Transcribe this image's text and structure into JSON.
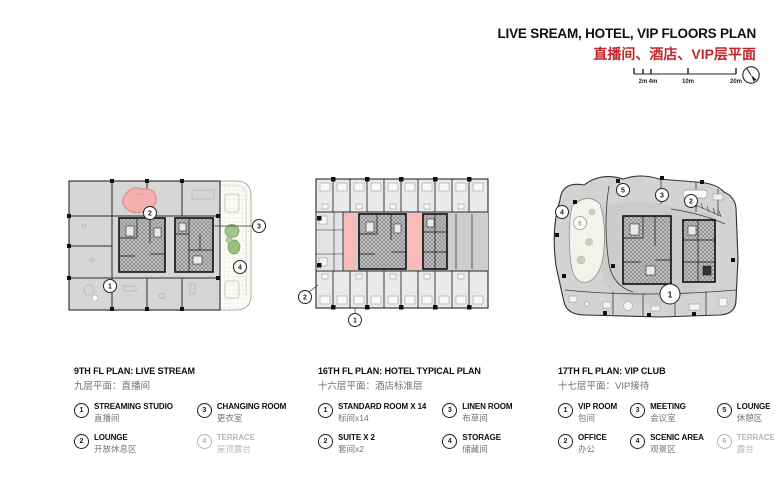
{
  "header": {
    "title": "LIVE SREAM, HOTEL, VIP FLOORS PLAN",
    "subtitle_cn": "直播间、酒店、VIP层平面",
    "accent_color": "#c0272d",
    "scale_bar": {
      "labels": [
        "2m",
        "4m",
        "10m",
        "20m"
      ]
    }
  },
  "plans": [
    {
      "title_en": "9TH FL PLAN: LIVE STREAM",
      "title_cn": "九层平面：直播间",
      "markers": [
        "1",
        "2",
        "3",
        "4"
      ],
      "legend": [
        {
          "num": "1",
          "en": "STREAMING STUDIO",
          "cn": "直播间",
          "muted": false
        },
        {
          "num": "2",
          "en": "LOUNGE",
          "cn": "开放休息区",
          "muted": false
        },
        {
          "num": "3",
          "en": "CHANGING ROOM",
          "cn": "更衣室",
          "muted": false
        },
        {
          "num": "4",
          "en": "TERRACE",
          "cn": "屋顶露台",
          "muted": true
        }
      ]
    },
    {
      "title_en": "16TH FL PLAN: HOTEL TYPICAL PLAN",
      "title_cn": "十六层平面：酒店标准层",
      "markers": [
        "1",
        "2",
        "3",
        "4"
      ],
      "legend": [
        {
          "num": "1",
          "en": "STANDARD ROOM X 14",
          "cn": "标间x14",
          "muted": false
        },
        {
          "num": "2",
          "en": "SUITE X 2",
          "cn": "套间x2",
          "muted": false
        },
        {
          "num": "3",
          "en": "LINEN ROOM",
          "cn": "布草间",
          "muted": false
        },
        {
          "num": "4",
          "en": "STORAGE",
          "cn": "储藏间",
          "muted": false
        }
      ]
    },
    {
      "title_en": "17TH FL PLAN: VIP CLUB",
      "title_cn": "十七层平面：VIP接待",
      "markers": [
        "1",
        "2",
        "3",
        "4",
        "5",
        "6"
      ],
      "legend": [
        {
          "num": "1",
          "en": "VIP ROOM",
          "cn": "包间",
          "muted": false
        },
        {
          "num": "2",
          "en": "OFFICE",
          "cn": "办公",
          "muted": false
        },
        {
          "num": "3",
          "en": "MEETING",
          "cn": "会议室",
          "muted": false
        },
        {
          "num": "4",
          "en": "SCENIC AREA",
          "cn": "观景区",
          "muted": false
        },
        {
          "num": "5",
          "en": "LOUNGE",
          "cn": "休憩区",
          "muted": false
        },
        {
          "num": "6",
          "en": "TERRACE",
          "cn": "露台",
          "muted": true
        }
      ]
    }
  ],
  "colors": {
    "plan_fill": "#d6d6d6",
    "corridor_fill": "#cecece",
    "pink_highlight": "#f5b9b7",
    "green_planting": "#a5c487",
    "wall": "#1f1f1f"
  }
}
